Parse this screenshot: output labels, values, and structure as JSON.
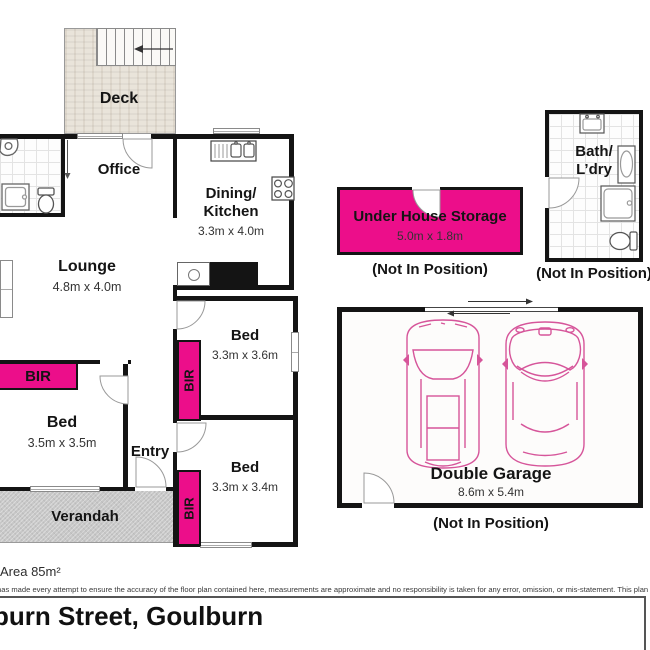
{
  "colors": {
    "pink": "#EC0E8A",
    "wall": "#141414",
    "car_outline": "#d6559a"
  },
  "plan": {
    "deck": {
      "name": "Deck"
    },
    "office": {
      "name": "Office"
    },
    "dining_kitchen": {
      "name_line1": "Dining/",
      "name_line2": "Kitchen",
      "dims": "3.3m x 4.0m"
    },
    "lounge": {
      "name": "Lounge",
      "dims": "4.8m x 4.0m"
    },
    "bed_main": {
      "name": "Bed",
      "dims": "3.5m x 3.5m"
    },
    "bed_two": {
      "name": "Bed",
      "dims": "3.3m x 3.6m"
    },
    "bed_three": {
      "name": "Bed",
      "dims": "3.3m x 3.4m"
    },
    "entry": {
      "name": "Entry"
    },
    "verandah": {
      "name": "Verandah"
    },
    "bir_label": "BIR"
  },
  "detached": {
    "storage": {
      "name": "Under House Storage",
      "dims": "5.0m x 1.8m",
      "note": "(Not In Position)"
    },
    "bath_laundry": {
      "name_line1": "Bath/",
      "name_line2": "L’dry",
      "note": "(Not In Position)"
    },
    "garage": {
      "name": "Double Garage",
      "dims": "8.6m x 5.4m",
      "note": "(Not In Position)"
    }
  },
  "footer": {
    "area": "Area 85m²",
    "disclaimer": "has made every attempt to ensure the accuracy of the floor plan contained here, measurements are approximate and no responsibility is taken for any error, omission, or mis-statement. This plan is for illu",
    "address": "burn Street, Goulburn"
  }
}
